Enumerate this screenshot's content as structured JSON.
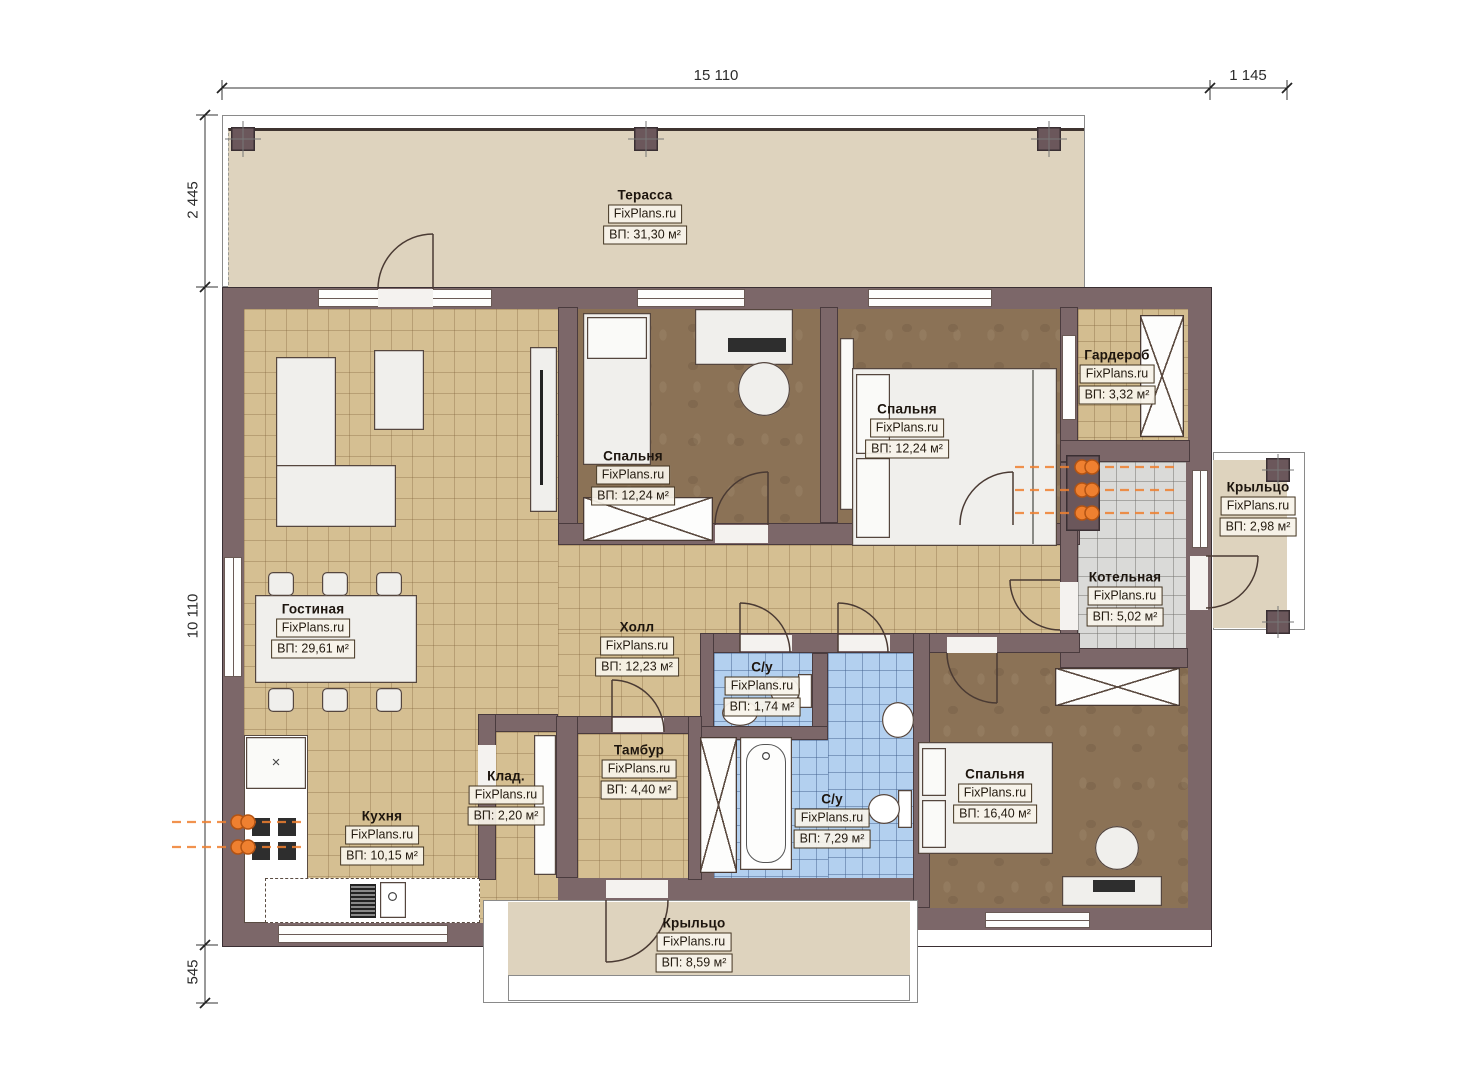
{
  "watermark": "FixPlans.ru",
  "dimensions": {
    "top_main": "15 110",
    "top_right": "1 145",
    "left_top": "2 445",
    "left_main": "10 110",
    "left_bottom": "545"
  },
  "rooms": [
    {
      "key": "terrace",
      "name": "Терасса",
      "area": "ВП: 31,30 м²"
    },
    {
      "key": "bedroom-top",
      "name": "Спальня",
      "area": "ВП: 12,24 м²"
    },
    {
      "key": "bedroom-top-right",
      "name": "Спальня",
      "area": "ВП: 12,24 м²"
    },
    {
      "key": "wardrobe-room",
      "name": "Гардероб",
      "area": "ВП: 3,32 м²"
    },
    {
      "key": "porch-right",
      "name": "Крыльцо",
      "area": "ВП: 2,98 м²"
    },
    {
      "key": "boiler-room",
      "name": "Котельная",
      "area": "ВП: 5,02 м²"
    },
    {
      "key": "living-room",
      "name": "Гостиная",
      "area": "ВП: 29,61 м²"
    },
    {
      "key": "hall",
      "name": "Холл",
      "area": "ВП: 12,23 м²"
    },
    {
      "key": "bathroom-small",
      "name": "С/у",
      "area": "ВП: 1,74 м²"
    },
    {
      "key": "bathroom-big",
      "name": "С/у",
      "area": "ВП: 7,29 м²"
    },
    {
      "key": "bedroom-bottom",
      "name": "Спальня",
      "area": "ВП: 16,40 м²"
    },
    {
      "key": "tambour",
      "name": "Тамбур",
      "area": "ВП: 4,40 м²"
    },
    {
      "key": "storage",
      "name": "Клад.",
      "area": "ВП: 2,20 м²"
    },
    {
      "key": "kitchen",
      "name": "Кухня",
      "area": "ВП: 10,15 м²"
    },
    {
      "key": "porch-bottom",
      "name": "Крыльцо",
      "area": "ВП: 8,59 м²"
    }
  ],
  "colors": {
    "wall": "#7c6769",
    "floor_tile_beige": "#d5bf92",
    "floor_dark_bedroom": "#8b7256",
    "floor_bathroom_blue": "#b3d0ef",
    "floor_boiler_gray": "#dadad8",
    "terrace_beige": "#ded3be",
    "radiator_orange": "#ef8030",
    "label_border": "#42331f"
  }
}
